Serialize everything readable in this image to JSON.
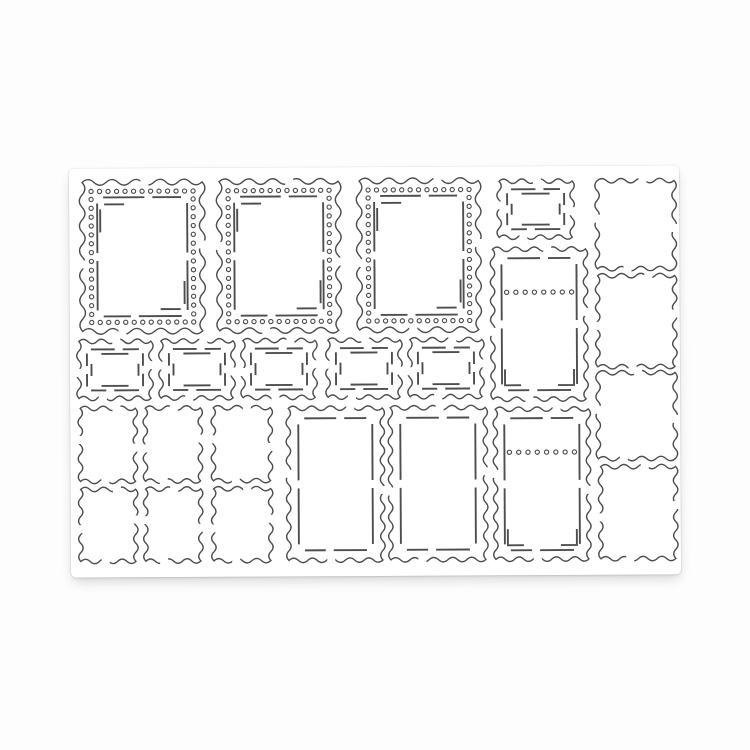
{
  "meta": {
    "description": "Product photo of a white die-cut sheet with postage-stamp shaped craft die frames",
    "background_color": "#fdfdfd"
  },
  "sheet": {
    "x": 70,
    "y": 167,
    "width": 610,
    "height": 409,
    "fill": "#ffffff"
  },
  "style": {
    "line_color": "#4e4e4e",
    "border_stroke": 1.4,
    "detail_stroke": 1.9,
    "dot_radius": 2.1,
    "dot_stroke": 1.15,
    "dot_spacing": 8.6,
    "wave": {
      "large": {
        "length": 12,
        "amplitude": 2.8
      },
      "default": {
        "length": 9.5,
        "amplitude": 2.2
      }
    }
  },
  "stamps": [
    {
      "name": "stamp-large-perforated-1",
      "type": "perforated",
      "x": 13,
      "y": 14,
      "w": 120,
      "h": 149
    },
    {
      "name": "stamp-large-perforated-2",
      "type": "perforated",
      "x": 150,
      "y": 14,
      "w": 119,
      "h": 149
    },
    {
      "name": "stamp-large-perforated-3",
      "type": "perforated",
      "x": 290,
      "y": 14,
      "w": 119,
      "h": 149
    },
    {
      "name": "stamp-small-frame-top",
      "type": "double-frame",
      "x": 430,
      "y": 15,
      "w": 73,
      "h": 56
    },
    {
      "name": "stamp-tall-dotted-1",
      "type": "dotted-tall",
      "x": 423,
      "y": 83,
      "w": 93,
      "h": 150
    },
    {
      "name": "stamp-tall-dotted-2",
      "type": "dotted-tall",
      "x": 425,
      "y": 243,
      "w": 93,
      "h": 150
    },
    {
      "name": "stamp-small-frame-1",
      "type": "double-frame",
      "x": 9,
      "y": 173,
      "w": 72,
      "h": 57
    },
    {
      "name": "stamp-small-frame-2",
      "type": "double-frame",
      "x": 91,
      "y": 173,
      "w": 72,
      "h": 57
    },
    {
      "name": "stamp-small-frame-3",
      "type": "double-frame",
      "x": 173,
      "y": 173,
      "w": 72,
      "h": 57
    },
    {
      "name": "stamp-small-frame-4",
      "type": "double-frame",
      "x": 258,
      "y": 173,
      "w": 72,
      "h": 57
    },
    {
      "name": "stamp-small-frame-5",
      "type": "double-frame",
      "x": 340,
      "y": 173,
      "w": 72,
      "h": 57
    },
    {
      "name": "stamp-plain-small-1",
      "type": "plain",
      "x": 10,
      "y": 240,
      "w": 55,
      "h": 73
    },
    {
      "name": "stamp-plain-small-2",
      "type": "plain",
      "x": 75,
      "y": 240,
      "w": 55,
      "h": 73
    },
    {
      "name": "stamp-plain-small-3",
      "type": "plain",
      "x": 143,
      "y": 240,
      "w": 57,
      "h": 73
    },
    {
      "name": "stamp-plain-small-4",
      "type": "plain",
      "x": 10,
      "y": 321,
      "w": 55,
      "h": 72
    },
    {
      "name": "stamp-plain-small-5",
      "type": "plain",
      "x": 75,
      "y": 321,
      "w": 55,
      "h": 72
    },
    {
      "name": "stamp-plain-small-6",
      "type": "plain",
      "x": 143,
      "y": 321,
      "w": 57,
      "h": 72
    },
    {
      "name": "stamp-tall-frame-1",
      "type": "inner-rect",
      "x": 218,
      "y": 241,
      "w": 94,
      "h": 152
    },
    {
      "name": "stamp-tall-frame-2",
      "type": "inner-rect",
      "x": 320,
      "y": 241,
      "w": 95,
      "h": 152
    },
    {
      "name": "stamp-plain-right-1",
      "type": "plain",
      "x": 528,
      "y": 15,
      "w": 77,
      "h": 88
    },
    {
      "name": "stamp-plain-right-2",
      "type": "plain",
      "x": 528,
      "y": 110,
      "w": 77,
      "h": 91
    },
    {
      "name": "stamp-plain-right-3",
      "type": "plain",
      "x": 528,
      "y": 207,
      "w": 77,
      "h": 86
    },
    {
      "name": "stamp-plain-right-4",
      "type": "plain",
      "x": 530,
      "y": 301,
      "w": 75,
      "h": 92
    }
  ]
}
